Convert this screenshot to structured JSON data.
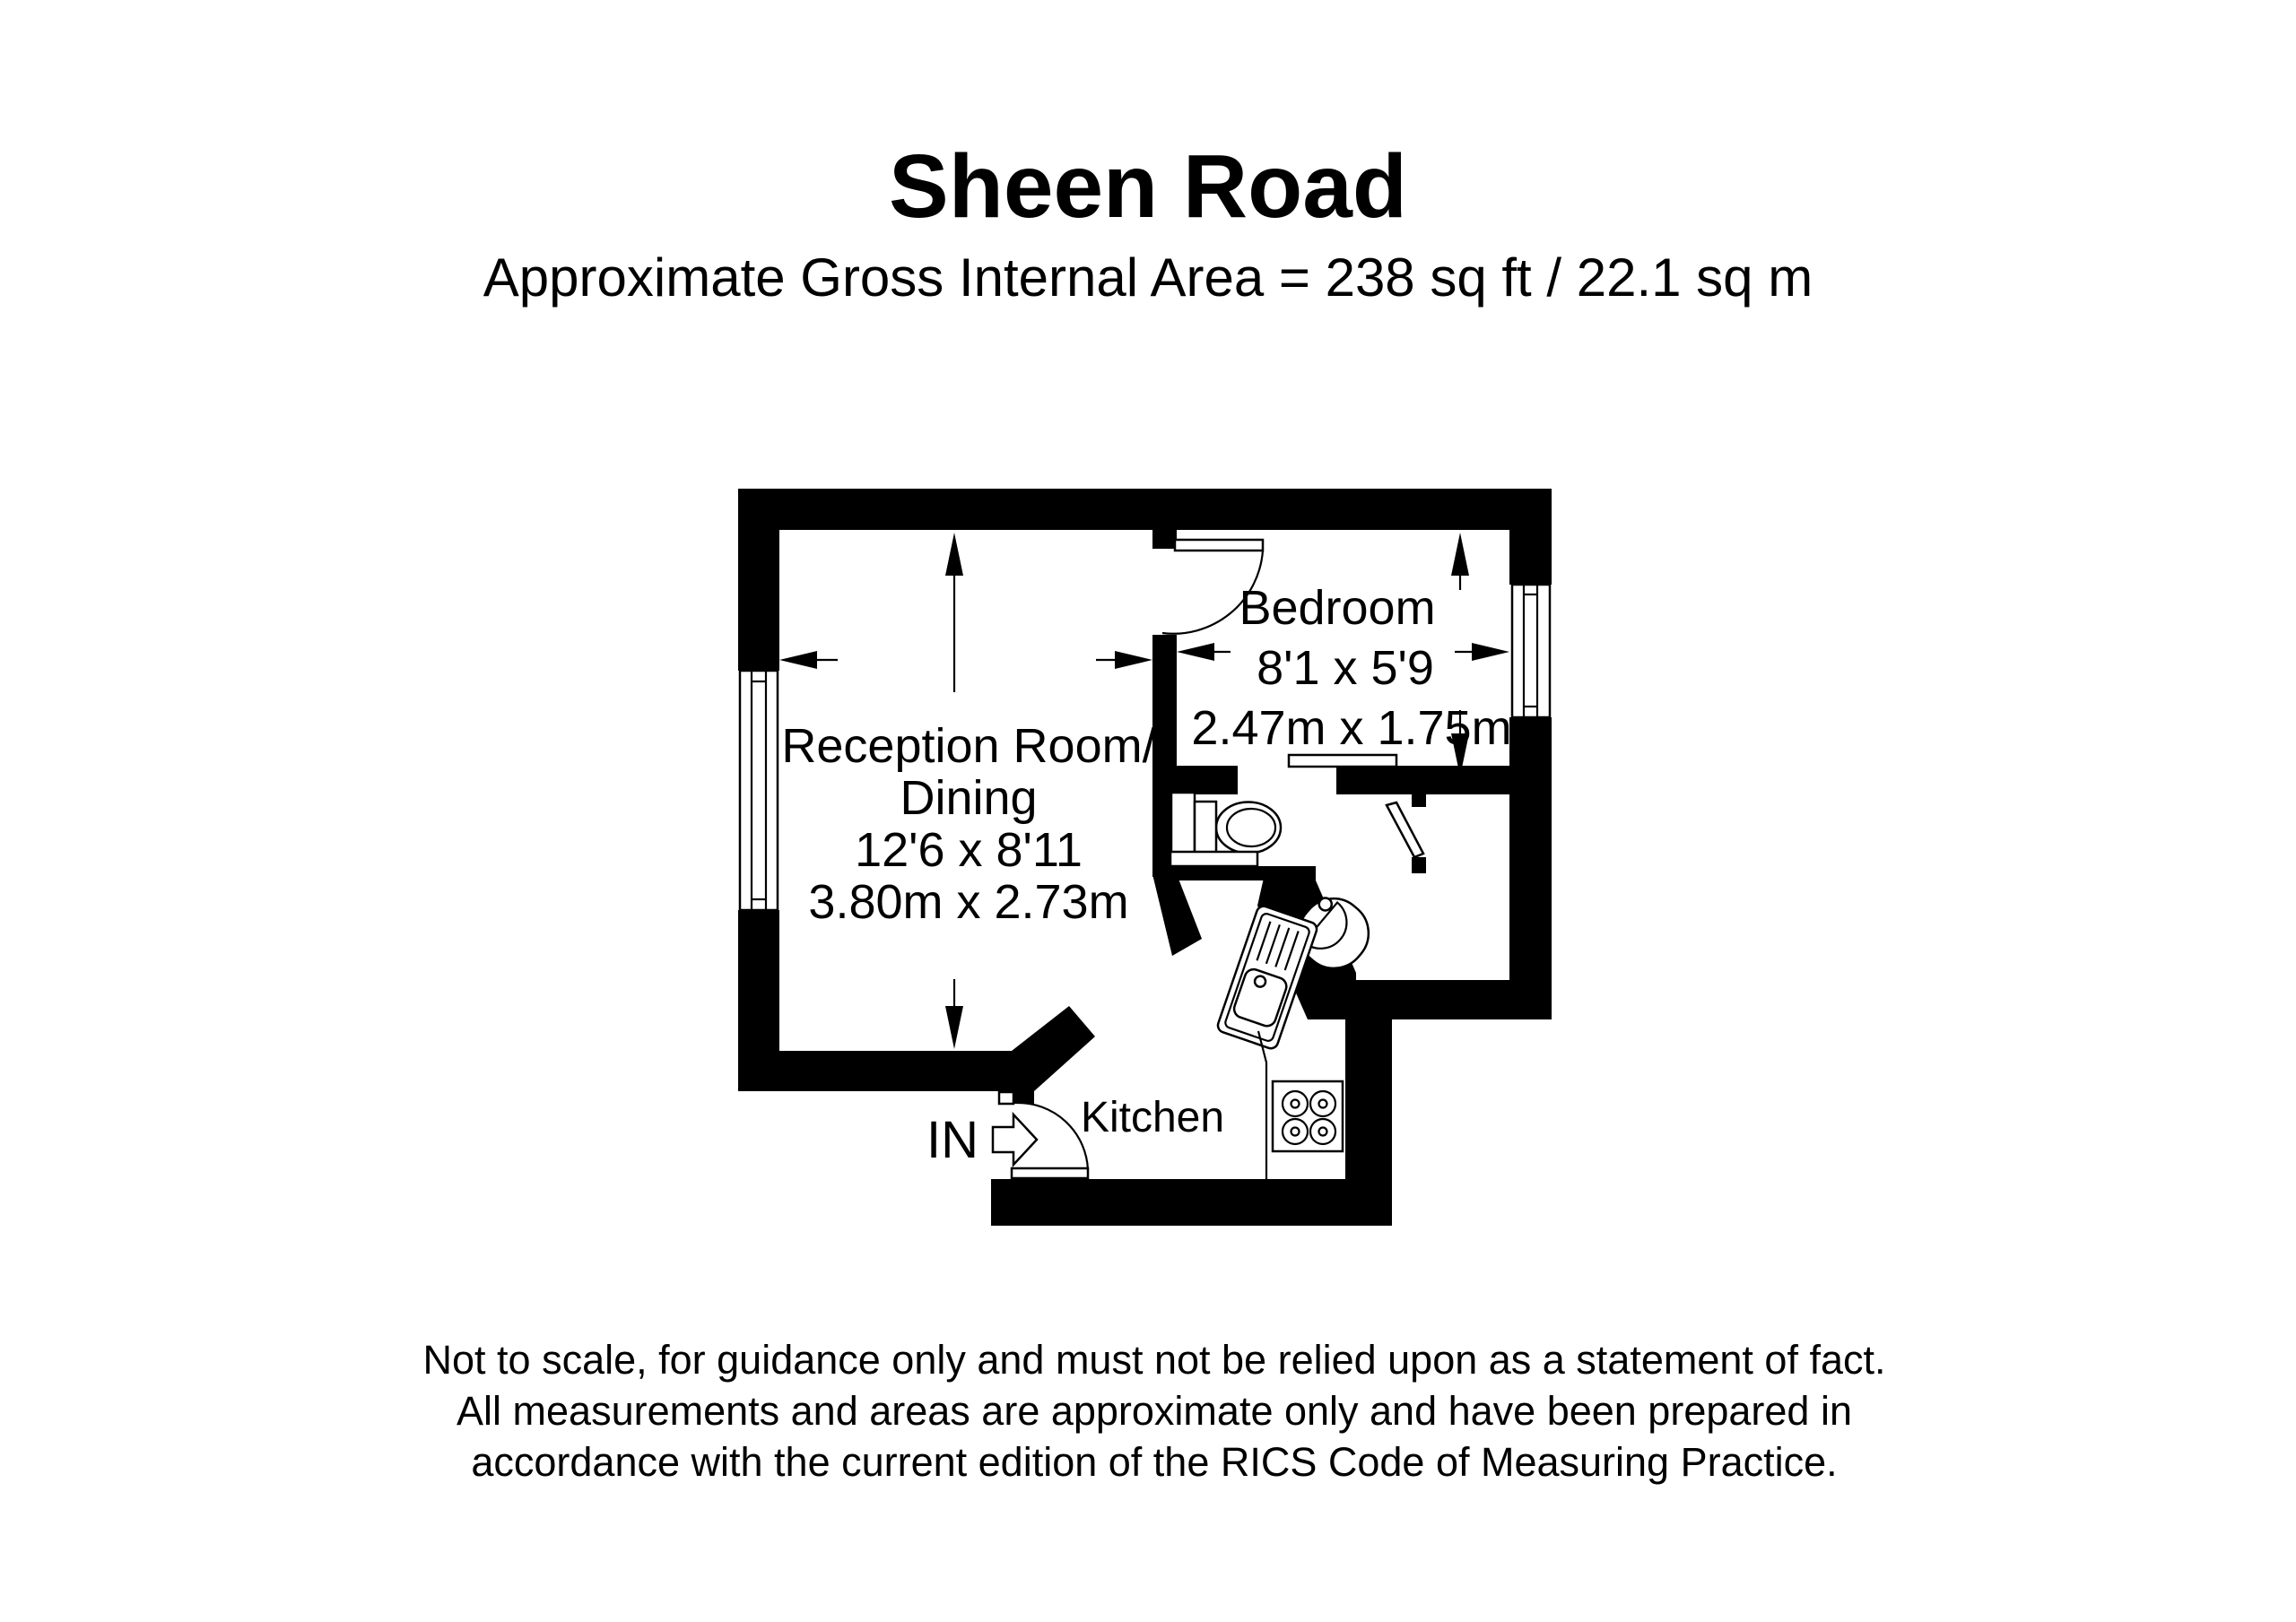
{
  "header": {
    "title": "Sheen Road",
    "subtitle": "Approximate Gross Internal Area = 238 sq ft / 22.1 sq m"
  },
  "rooms": {
    "reception": {
      "name_line1": "Reception Room/",
      "name_line2": "Dining",
      "size_imperial": "12'6 x 8'11",
      "size_metric": "3.80m x 2.73m"
    },
    "bedroom": {
      "name": "Bedroom",
      "size_imperial": "8'1 x 5'9",
      "size_metric": "2.47m x 1.75m"
    },
    "kitchen": {
      "name": "Kitchen"
    },
    "entrance": {
      "label": "IN"
    }
  },
  "footer": {
    "line1": "Not to scale, for guidance only and must not be relied upon as a statement of fact.",
    "line2": "All measurements and areas are approximate only and have been prepared in",
    "line3": "accordance with the current edition of the RICS Code of Measuring Practice."
  },
  "colors": {
    "wall": "#000000",
    "background": "#ffffff"
  }
}
